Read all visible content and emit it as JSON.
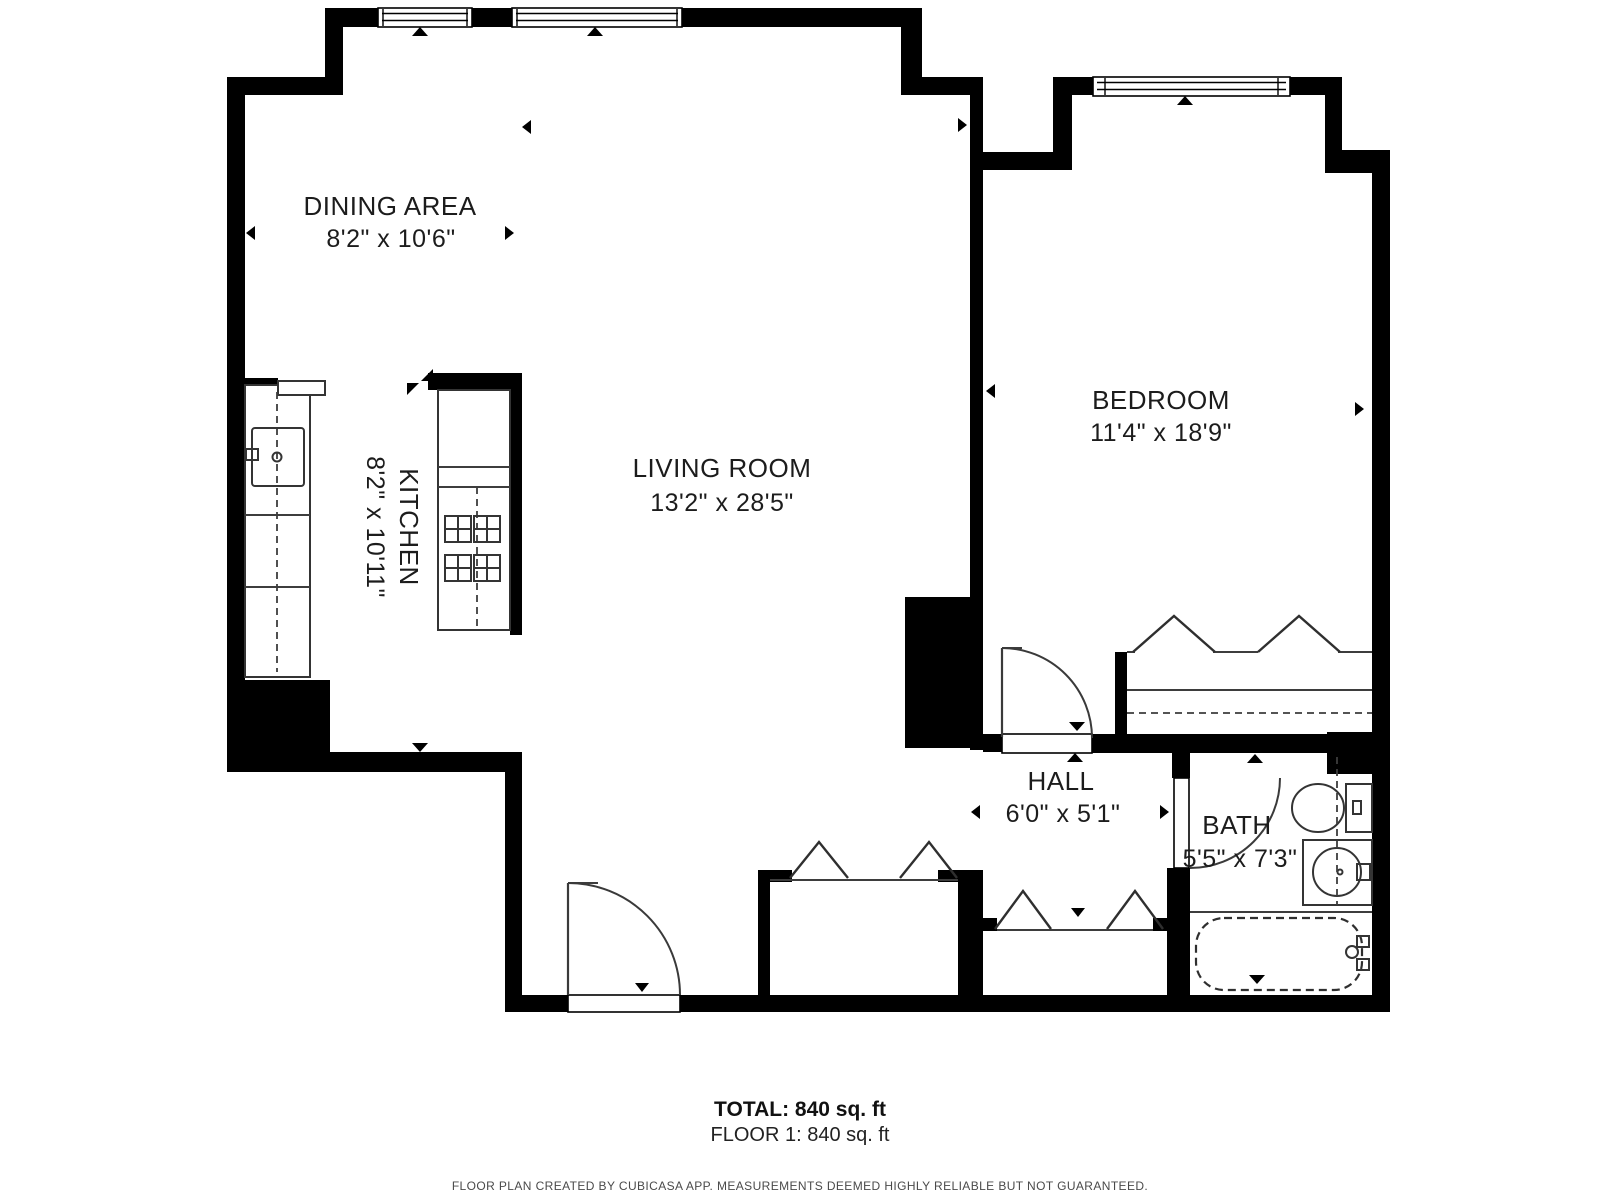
{
  "plan": {
    "rooms": {
      "dining": {
        "name": "DINING AREA",
        "dims": "8'2\" x 10'6\""
      },
      "kitchen": {
        "name": "KITCHEN",
        "dims": "8'2\" x 10'11\""
      },
      "living": {
        "name": "LIVING ROOM",
        "dims": "13'2\" x 28'5\""
      },
      "bedroom": {
        "name": "BEDROOM",
        "dims": "11'4\" x 18'9\""
      },
      "hall": {
        "name": "HALL",
        "dims": "6'0\" x 5'1\""
      },
      "bath": {
        "name": "BATH",
        "dims": "5'5\" x 7'3\""
      }
    },
    "summary": {
      "total": "TOTAL: 840 sq. ft",
      "floor": "FLOOR 1: 840 sq. ft"
    },
    "footer": "FLOOR PLAN CREATED BY CUBICASA APP. MEASUREMENTS DEEMED HIGHLY RELIABLE BUT NOT GUARANTEED.",
    "colors": {
      "wall": "#000000",
      "background": "#ffffff",
      "fixture_line": "#3d3d3d"
    }
  }
}
